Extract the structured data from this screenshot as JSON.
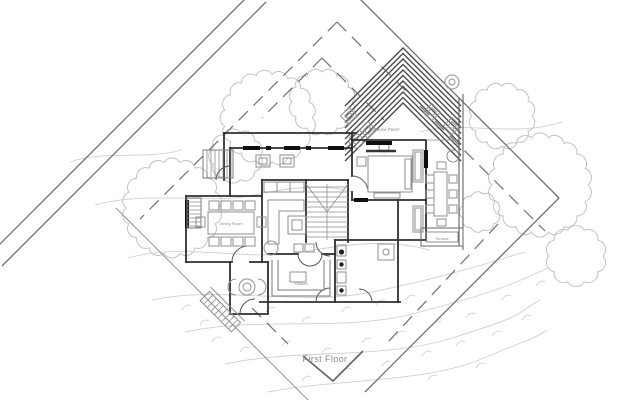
{
  "drawing": {
    "caption": "First Floor",
    "rooms": {
      "dining_room": "Dining Room",
      "kitchen": "Kitchen",
      "porch": "Entrance Porch",
      "terrace_tag": "Terrace"
    }
  },
  "colors": {
    "paper": "#ffffff",
    "ink": "#2e2e2e",
    "mid": "#6f6f6f",
    "light": "#8f8f8f",
    "faint": "#cfcfcf",
    "tree": "#c2c2c2",
    "label": "#8a8a8a"
  }
}
